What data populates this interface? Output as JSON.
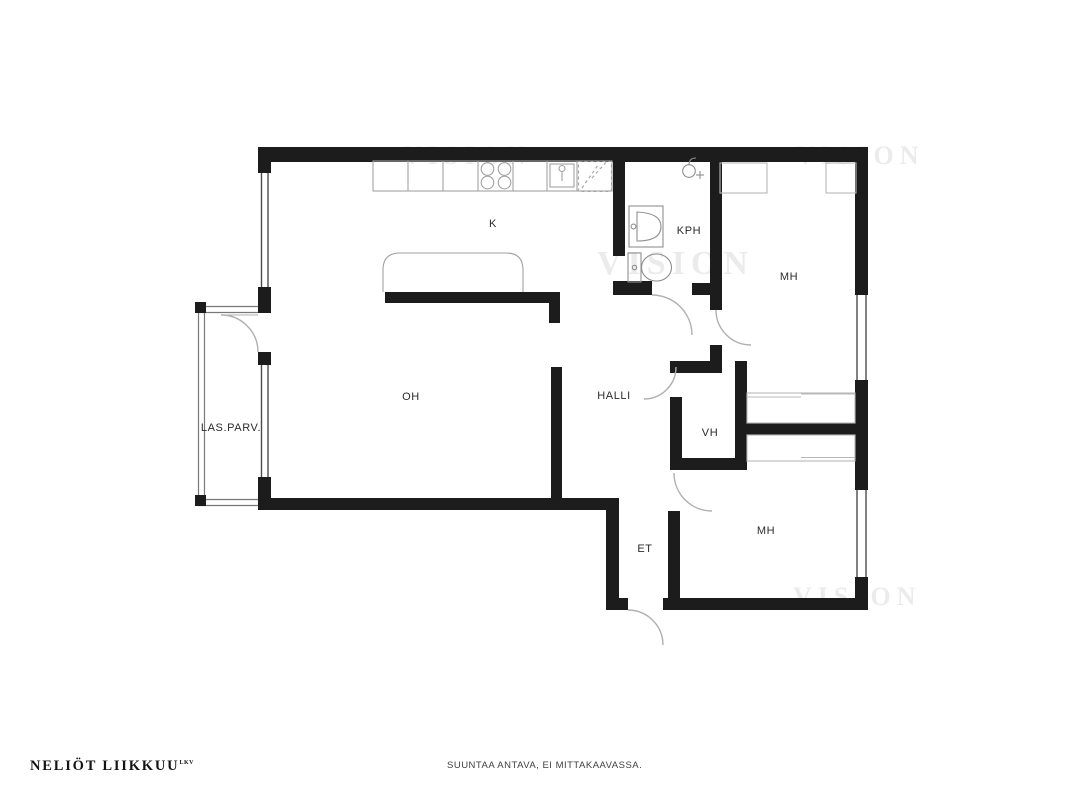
{
  "branding": {
    "logo": "NELIÖT LIIKKUU",
    "logo_superscript": "LKV"
  },
  "footer": {
    "disclaimer": "SUUNTAA ANTAVA, EI MITTAKAAVASSA."
  },
  "watermark": "VISION",
  "floorplan": {
    "type": "apartment-floor-plan",
    "rooms": [
      {
        "label": "K",
        "name": "kitchen"
      },
      {
        "label": "KPH",
        "name": "bathroom"
      },
      {
        "label": "MH",
        "name": "bedroom-top"
      },
      {
        "label": "OH",
        "name": "living-room"
      },
      {
        "label": "HALLI",
        "name": "hall"
      },
      {
        "label": "LAS.PARV.",
        "name": "glazed-balcony"
      },
      {
        "label": "VH",
        "name": "closet"
      },
      {
        "label": "ET",
        "name": "entry"
      },
      {
        "label": "MH",
        "name": "bedroom-bottom"
      }
    ],
    "colors": {
      "wall": "#1c1c1c",
      "fixture": "#9e9e9e",
      "door_arc": "#b0b0b0",
      "wardrobe": "#b8b8b8",
      "balcony_line": "#787878"
    }
  }
}
